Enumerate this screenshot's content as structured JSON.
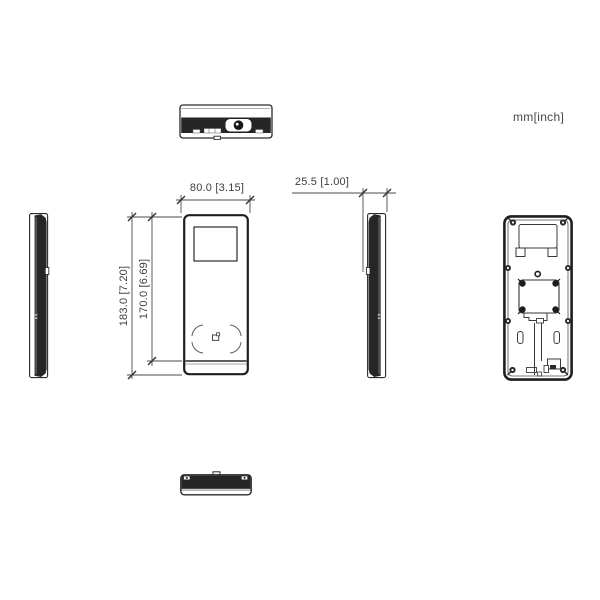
{
  "labels": {
    "unit": "mm[inch]"
  },
  "dims": {
    "width": "80.0 [3.15]",
    "height_outer": "183.0 [7.20]",
    "height_inner": "170.0 [6.69]",
    "depth": "25.5 [1.00]"
  },
  "colors": {
    "ink": "#262626",
    "outline": "#2a2a2a",
    "dimension_line": "#4a4a4a",
    "text": "#3f3f3f",
    "background": "#ffffff"
  }
}
